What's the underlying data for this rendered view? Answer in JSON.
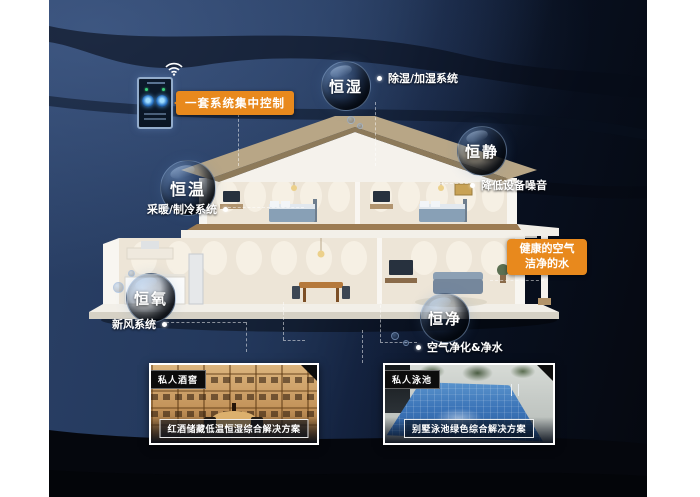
{
  "colors": {
    "accent_orange": "#E8891D",
    "canvas_navy": "#22375A",
    "canvas_dark": "#060B16",
    "text_white": "#FFFFFF"
  },
  "control_panel": {
    "callout_label": "一套系统集中控制",
    "icons": {
      "wifi": "wifi-icon",
      "dials": "thermostat-dial-icons"
    }
  },
  "bubbles": [
    {
      "label": "恒湿"
    },
    {
      "label": "恒静"
    },
    {
      "label": "恒温"
    },
    {
      "label": "恒氧"
    },
    {
      "label": "恒净"
    }
  ],
  "system_labels": [
    {
      "text": "除湿/加湿系统"
    },
    {
      "text": "降低设备噪音"
    },
    {
      "text": "采暖/制冷系统"
    },
    {
      "text": "新风系统"
    },
    {
      "text": "空气净化&净水"
    }
  ],
  "highlight_box": {
    "line1": "健康的空气",
    "line2": "洁净的水"
  },
  "photos": [
    {
      "tag": "私人酒窖",
      "caption": "红酒储藏低温恒湿综合解决方案"
    },
    {
      "tag": "私人泳池",
      "caption": "别墅泳池绿色综合解决方案"
    }
  ]
}
